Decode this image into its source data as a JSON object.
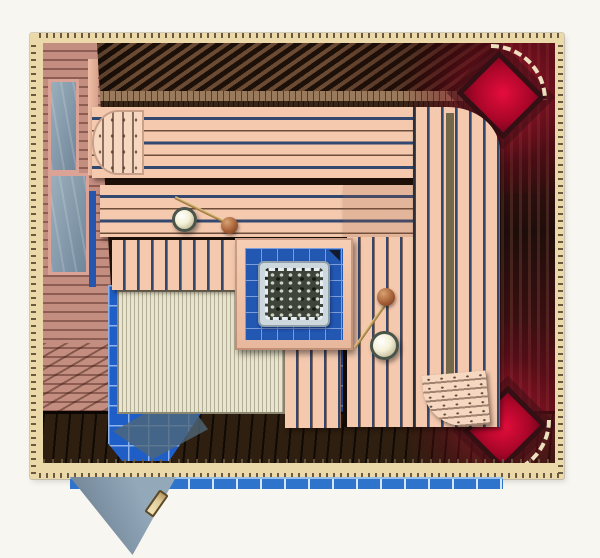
{
  "scene": {
    "type": "sauna-interior-rendering",
    "view": "overhead top-down 3d rendering",
    "objects": [
      {
        "name": "log-wall-frame",
        "note": "cream sauna log frame with notched tick edges"
      },
      {
        "name": "back-wall-paneling",
        "note": "dark brown diagonal wood paneling, top"
      },
      {
        "name": "left-wall-paneling",
        "note": "mauve horizontal planks with two glass windows"
      },
      {
        "name": "right-wall-paneling",
        "note": "dark vertical planks with red glow"
      },
      {
        "name": "upper-bench",
        "note": "peach wood bench, horizontal slats"
      },
      {
        "name": "upper-bench-headrest",
        "note": "rounded headrest, vertical slats, left end"
      },
      {
        "name": "lower-bench",
        "note": "second level bench, horizontal slats"
      },
      {
        "name": "right-bench",
        "note": "wide bench along right wall, vertical slats"
      },
      {
        "name": "right-bench-headrest",
        "note": "rounded headrest with peg dots, bottom right"
      },
      {
        "name": "front-step-bench",
        "note": "low step, vertical slats, lower left"
      },
      {
        "name": "heater-platform",
        "note": "blue tiled platform with wooden frame, center"
      },
      {
        "name": "sauna-heater",
        "note": "stove tray filled with grey stones"
      },
      {
        "name": "water-bucket-upper",
        "note": "round bucket with ladle on upper bench"
      },
      {
        "name": "water-bucket-right",
        "note": "round bucket with ladle on right bench"
      },
      {
        "name": "corner-light-top-right",
        "note": "glowing red corner lamp panel with dashed trim arc"
      },
      {
        "name": "corner-light-bottom-right",
        "note": "glowing red corner lamp panel with dashed trim arc"
      },
      {
        "name": "blue-tile-floor",
        "note": "royal blue tiled floor area, lower left"
      },
      {
        "name": "floor-duckboard",
        "note": "pale wooden duckboard mat on tiles"
      },
      {
        "name": "walkway-floor",
        "note": "dark brown plank floor along bottom"
      },
      {
        "name": "glass-door-open",
        "note": "grey-blue glass door swung open outward with wooden handle"
      },
      {
        "name": "exterior-tile-strip",
        "note": "blue tile strip outside the doorway"
      }
    ]
  },
  "palette": {
    "paper": "#f8f6f0",
    "frameCream": "#ecd9a9",
    "frameTick": "#6b5a40",
    "interiorDark": "#20130a",
    "wallTopDark": "#1c1008",
    "wallTopLight": "#6b4b33",
    "ledgeMid": "#9a7a5c",
    "ledgeDark": "#3a2617",
    "mauve": "#c38d80",
    "mauveLine": "#8d5c52",
    "winFrame": "#dba395",
    "glassLight": "#9aaebc",
    "glassDark": "#71879a",
    "royalBlue": "#2456b0",
    "wallRightDark": "#170e09",
    "wallRightLight": "#3f2a20",
    "redBright": "#e60d3c",
    "redDeep": "#7c0420",
    "arcCream": "#ece0c0",
    "bench": "#f4c9ae",
    "headrest": "#f6d8c0",
    "slatNavy": "#33486e",
    "slatBrown": "#6e4c3a",
    "floorDark": "#2e1f10",
    "floorLine": "#100a04",
    "tileBlue": "#1f5ec6",
    "tileGrid": "#8fb2e8",
    "platBlue": "#2257b2",
    "platGrid": "#7e9cd8",
    "heaterFrame": "#ccd7de",
    "stoneBase": "#3e443a",
    "stoneLight": "#cdd2c2",
    "stoneDark": "#171c12",
    "duck": "#e9e4cd",
    "duckLine": "#b3ae96",
    "duckEdge": "#8d8872",
    "doorGlassLight": "#93a9ba",
    "doorGlassDark": "#74889a",
    "handleWood": "#e3cf9e",
    "handleEdge": "#5f4a26",
    "extBlue": "#2f74cc",
    "extGap": "#d8e6f4",
    "bucketFill": "#f4f0d6",
    "bucketRim": "#49544a",
    "ladleWood": "#a55f36"
  }
}
